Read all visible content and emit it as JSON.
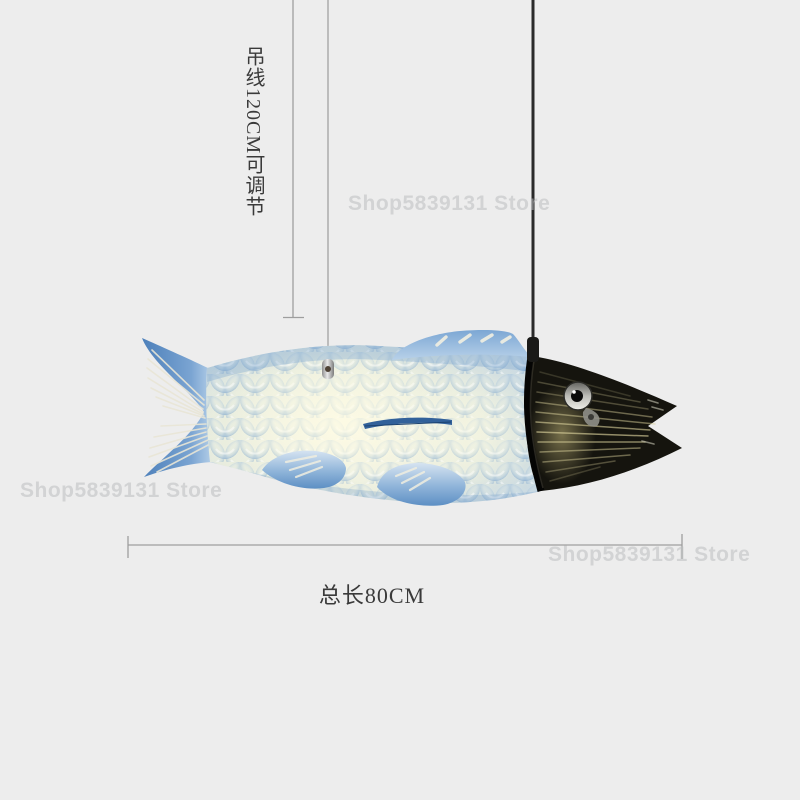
{
  "theme": {
    "bg": "#ededed",
    "label-color": "#3a3a3a",
    "dim-line-color": "#9e9e9e",
    "watermark-color": "rgba(188,189,192,0.55)",
    "fish-blue": "#6f9cc9",
    "fish-glow": "#f6f2dd",
    "head-black": "#17150f",
    "cable-black": "#2a2a2a",
    "wire-silver": "#a8a8a8"
  },
  "watermark": {
    "text": "Shop5839131 Store"
  },
  "annotations": {
    "wire_length_label": "吊线120CM可调节",
    "total_length_label": "总长80CM"
  },
  "product": {
    "type": "koi-fish-pendant-lamp",
    "adjustable_wire_length": "120CM",
    "total_length": "80CM"
  }
}
